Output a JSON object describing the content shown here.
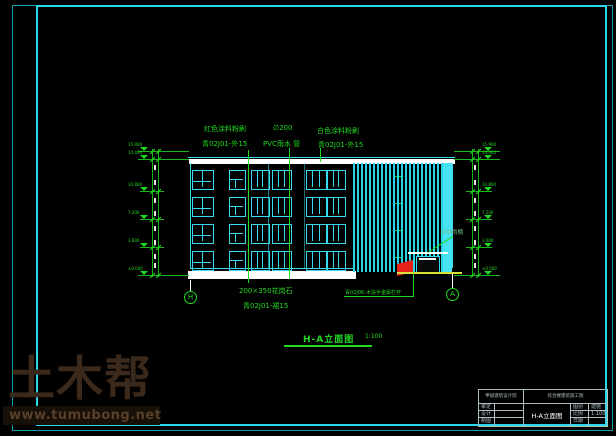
{
  "colors": {
    "background": "#000000",
    "frame_cyan": "#2ad8e8",
    "building_cyan": "#39d9ee",
    "annotation_green": "#21d921",
    "canopy_red": "#e8201a",
    "ground_yellow": "#d8e03a",
    "watermark_brown": "#3b2a1c"
  },
  "annotations": {
    "red_paint": {
      "line1": "红色涂料粉刷",
      "line2": "青02J01-外15"
    },
    "pvc_pipe": {
      "line1": "∅200",
      "line2": "PVC雨水 管"
    },
    "white_paint": {
      "line1": "白色涂料粉刷",
      "line2": "青02J01-外15"
    },
    "granite": {
      "line1": "200×350花岗石",
      "line2": "青02J01-裙15"
    },
    "railing_note": "青02J06-木扶手金属栏杆",
    "canopy_label": "彩钢雨棚"
  },
  "drawing_title": {
    "label": "H-A立面图",
    "scale": "1:100"
  },
  "axis_bubbles": {
    "left": "H",
    "right": "A"
  },
  "dimensions": {
    "left_levels": [
      "15.900",
      "14.400",
      "10.800",
      "7.200",
      "3.600",
      "±0.000"
    ],
    "right_levels": [
      "15.900",
      "14.400",
      "10.800",
      "7.200",
      "3.600",
      "±0.000"
    ]
  },
  "title_block": {
    "company": "甲级建筑设计院",
    "project": "综合楼建筑施工图",
    "drawing_name": "H-A立面图",
    "rows_left": [
      {
        "label": "审定",
        "value": ""
      },
      {
        "label": "设计",
        "value": ""
      },
      {
        "label": "制图",
        "value": ""
      }
    ],
    "rows_right": [
      {
        "label": "图别",
        "value": "建施"
      },
      {
        "label": "比例",
        "value": "1:100"
      },
      {
        "label": "日期",
        "value": ""
      }
    ]
  },
  "watermark": {
    "logo": "土木帮",
    "url": "www.tumubong.net"
  }
}
